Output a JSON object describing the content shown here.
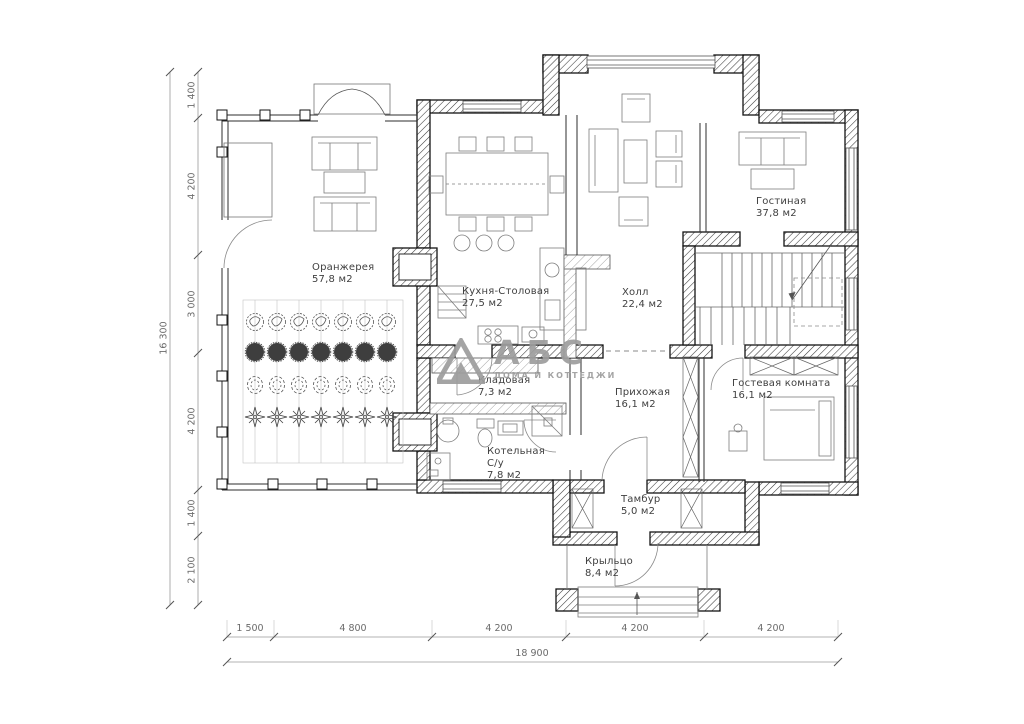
{
  "rooms": [
    {
      "name": "Оранжерея",
      "area": "57,8 м2"
    },
    {
      "name": "Кухня-Столовая",
      "area": "27,5 м2"
    },
    {
      "name": "Холл",
      "area": "22,4 м2"
    },
    {
      "name": "Гостиная",
      "area": "37,8 м2"
    },
    {
      "name": "Кладовая",
      "area": "7,3 м2"
    },
    {
      "name": "Прихожая",
      "area": "16,1 м2"
    },
    {
      "name": "Гостевая комната",
      "area": "16,1 м2"
    },
    {
      "name": "Котельная",
      "name2": "С/у",
      "area": "7,8 м2"
    },
    {
      "name": "Тамбур",
      "area": "5,0 м2"
    },
    {
      "name": "Крыльцо",
      "area": "8,4 м2"
    }
  ],
  "dimensions": {
    "vertical": [
      "1 400",
      "4 200",
      "3 000",
      "4 200",
      "1 400",
      "2 100"
    ],
    "vertical_total": "16 300",
    "horizontal": [
      "1 500",
      "4 800",
      "4 200",
      "4 200",
      "4 200"
    ],
    "horizontal_total": "18 900"
  },
  "logo": {
    "name": "АБС",
    "tagline": "ДОМА И КОТТЕДЖИ"
  },
  "colors": {
    "walls": "#141414",
    "furniture": "#7d7d7d",
    "dimensions": "#6b6b6b",
    "logo": "#9d9d9d"
  }
}
